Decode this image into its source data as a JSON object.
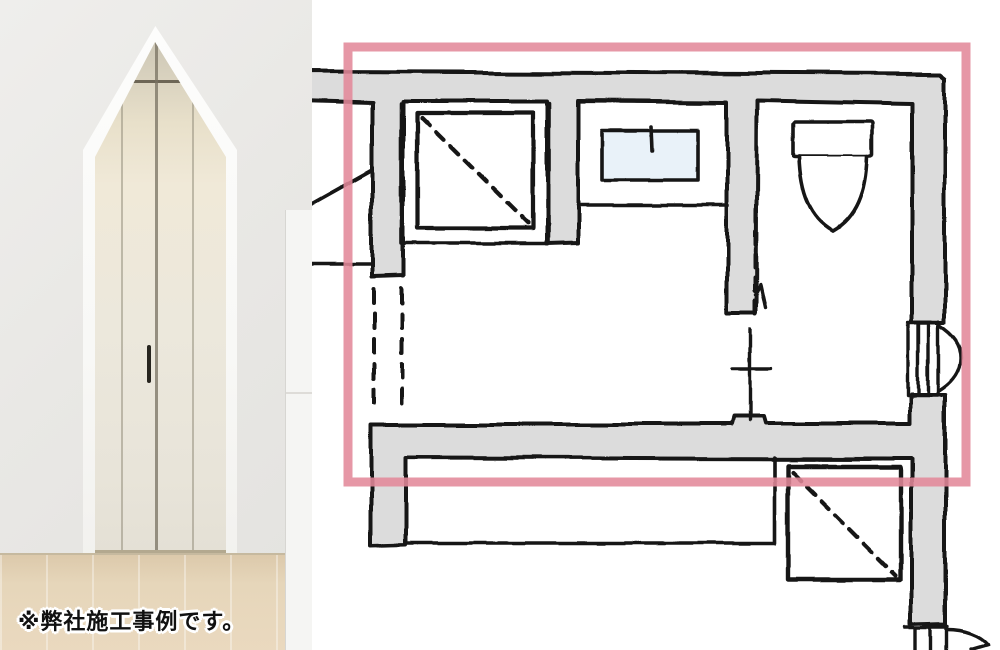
{
  "page": {
    "width": 1000,
    "height": 650,
    "background": "#ffffff"
  },
  "photo": {
    "caption": "※弊社施工事例です。",
    "subject": "pointed-arch-doorway-with-white-closet-doors"
  },
  "floor_plan": {
    "style": "hand-drawn",
    "colors": {
      "highlight": "#e2899a",
      "wall_fill": "#dcdcdc",
      "line": "#161616",
      "sink_water": "#e9f2f9",
      "paper": "#ffffff"
    },
    "fixtures": [
      {
        "name": "washer-pan-square",
        "symbol": "square-with-dashed-diagonal"
      },
      {
        "name": "vanity-basin",
        "symbol": "rectangle-with-faucet-tick"
      },
      {
        "name": "toilet",
        "symbol": "tank-and-bowl"
      },
      {
        "name": "storage-square-lower-right",
        "symbol": "square-with-dashed-diagonal"
      }
    ],
    "openings": [
      {
        "name": "left-opening",
        "symbol": "double-dashed-lines"
      },
      {
        "name": "toilet-partition",
        "symbol": "dashed-line-with-cross-door-line"
      },
      {
        "name": "right-wall-door",
        "symbol": "jamb-with-swing-arc"
      },
      {
        "name": "bottom-right-door",
        "symbol": "jamb-with-swing-arc"
      }
    ],
    "highlight_box": {
      "x": 348,
      "y": 47,
      "width": 618,
      "height": 435
    }
  }
}
